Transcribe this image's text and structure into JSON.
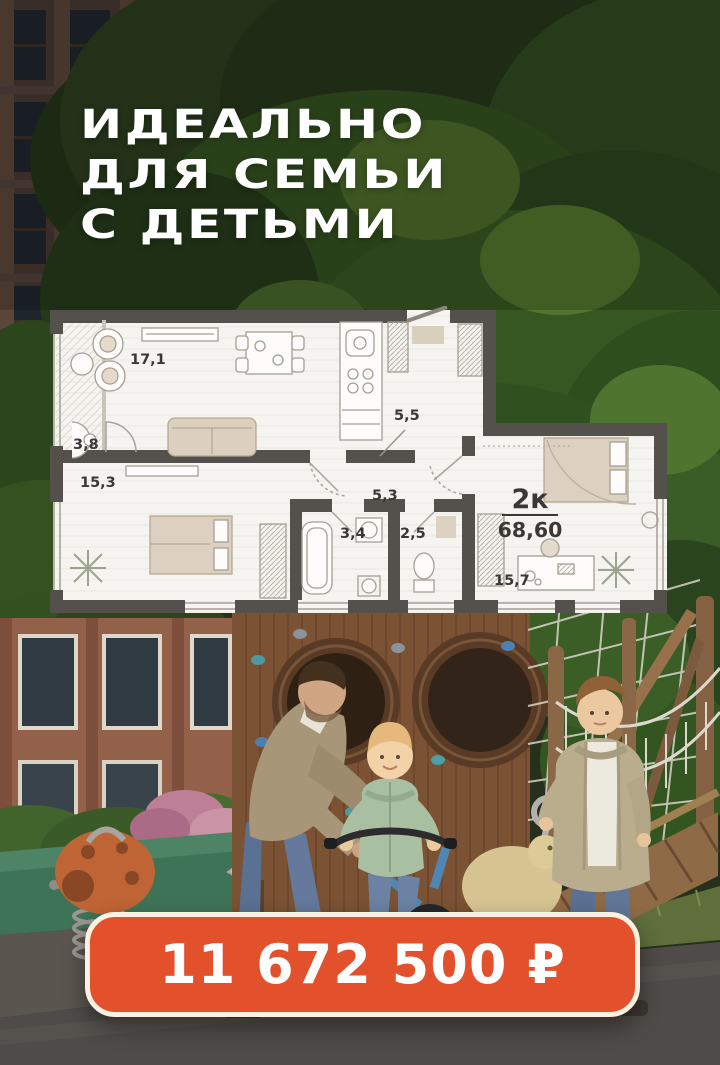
{
  "headline": {
    "line1": "ИДЕАЛЬНО",
    "line2": "ДЛЯ СЕМЬИ",
    "line3": "С ДЕТЬМИ"
  },
  "floor_plan": {
    "type_label": "2к",
    "total_area": "68,60",
    "rooms": [
      {
        "name": "living-dining",
        "area": "17,1"
      },
      {
        "name": "balcony",
        "area": "3,8"
      },
      {
        "name": "bedroom",
        "area": "15,3"
      },
      {
        "name": "entry-hall",
        "area": "5,5"
      },
      {
        "name": "corridor",
        "area": "5,3"
      },
      {
        "name": "bathroom",
        "area": "3,4"
      },
      {
        "name": "wc",
        "area": "2,5"
      },
      {
        "name": "room",
        "area": "15,7"
      }
    ]
  },
  "price": {
    "value": "11 672 500 ₽"
  },
  "colors": {
    "accent_orange": "#E2512B",
    "badge_border_cream": "#FAF1E3",
    "plan_wall_gray": "#54514C",
    "plan_floor": "#F6F4F0",
    "furniture_beige": "#DBD0C0",
    "headline_white": "#FFFFFF"
  }
}
